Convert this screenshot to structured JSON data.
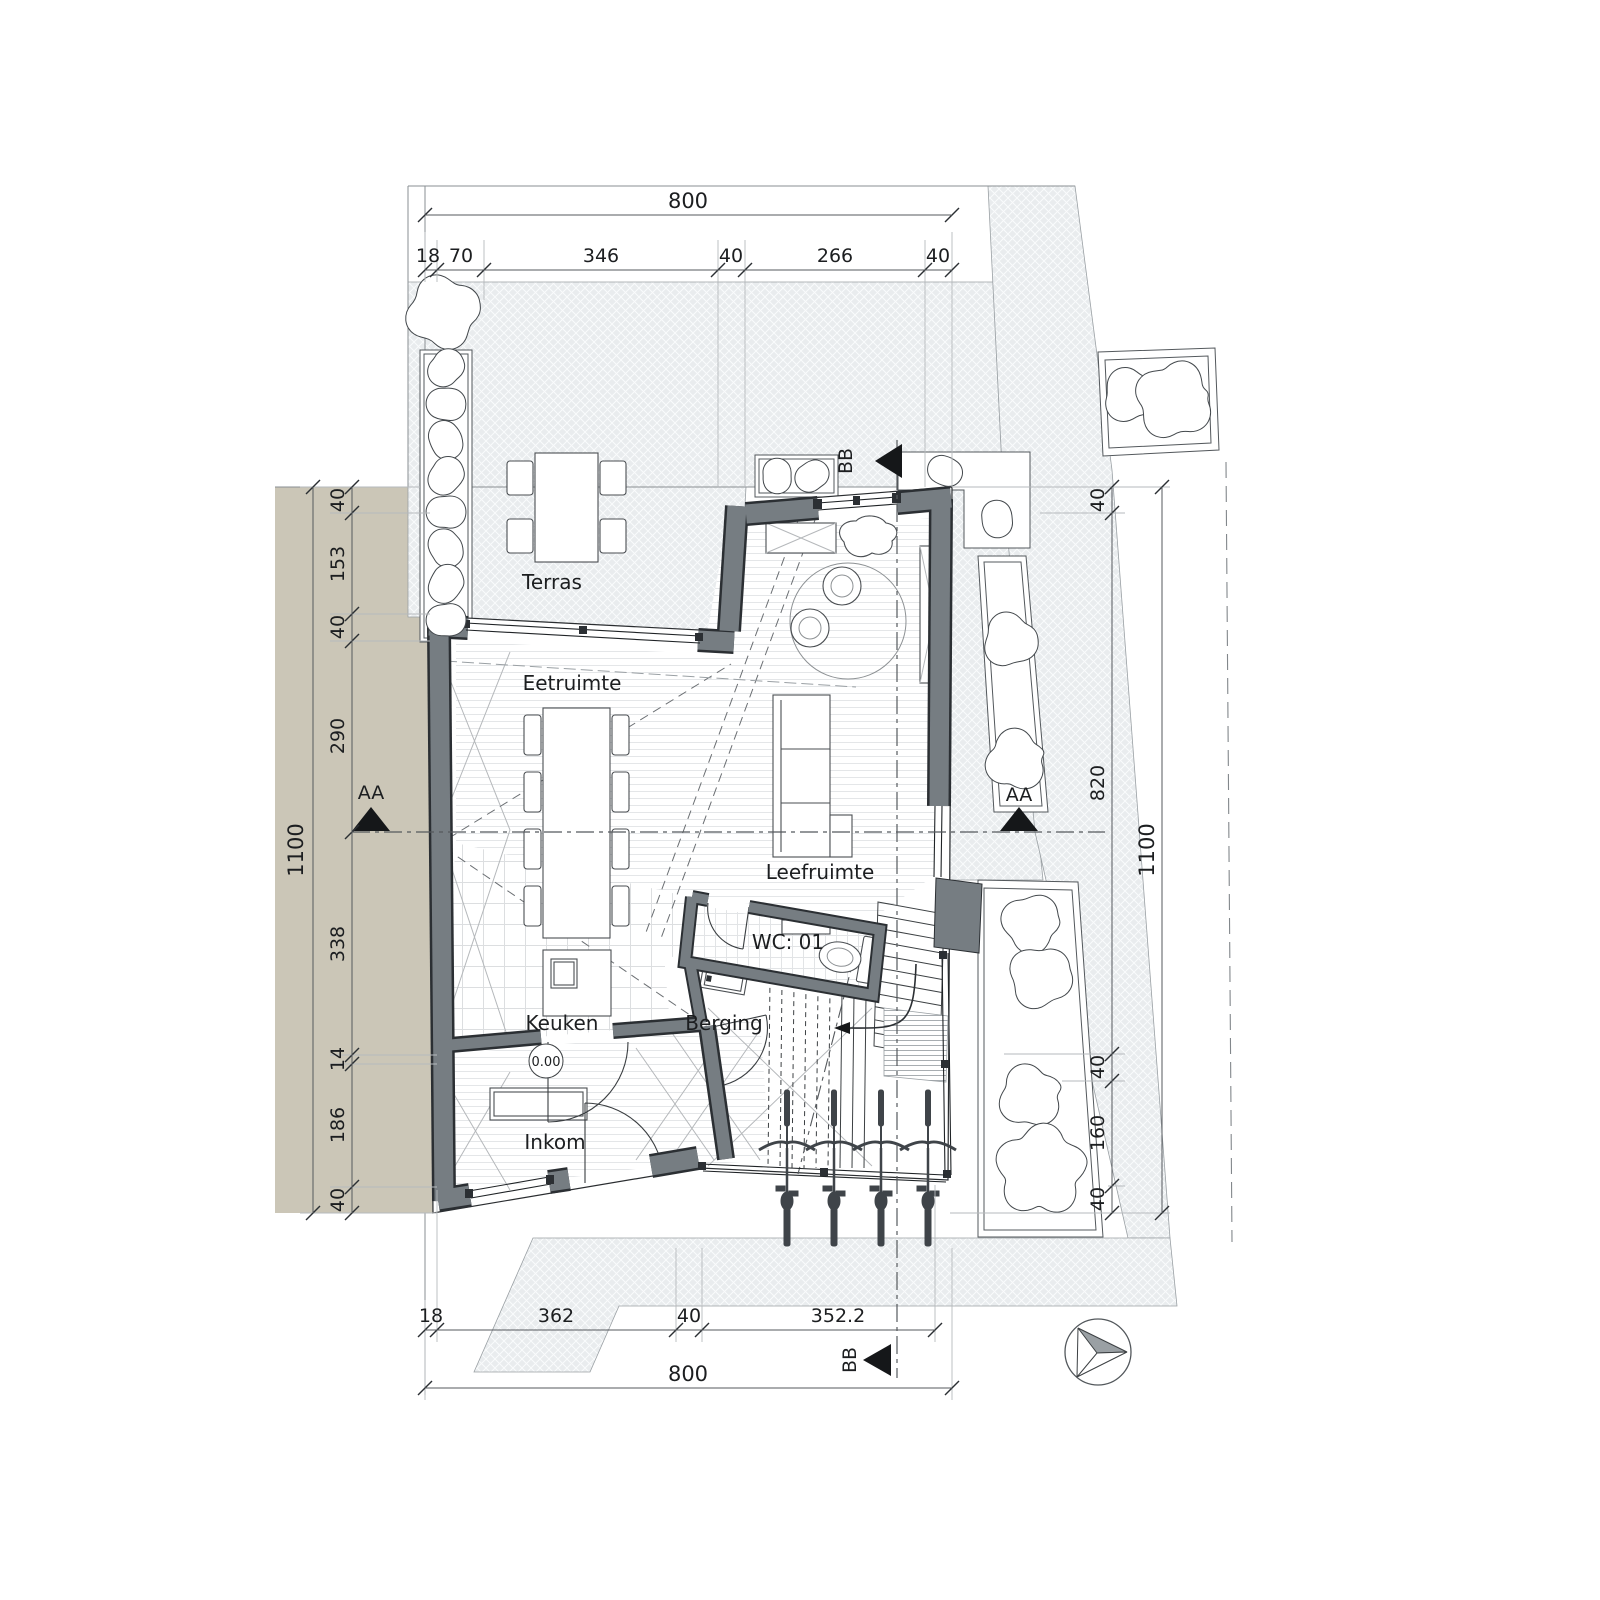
{
  "plan": {
    "rooms": {
      "terras": "Terras",
      "eetruimte": "Eetruimte",
      "leefruimte": "Leefruimte",
      "keuken": "Keuken",
      "berging": "Berging",
      "inkom": "Inkom",
      "wc": "WC: 01"
    },
    "level_marker": "0.00",
    "section_markers": {
      "aa": "AA",
      "bb": "BB"
    },
    "dimensions": {
      "top": {
        "overall": "800",
        "segments": [
          "18",
          "70",
          "346",
          "40",
          "266",
          "40"
        ]
      },
      "left": {
        "overall": "1100",
        "segments": [
          "40",
          "153",
          "40",
          "290",
          "338",
          "14",
          "186",
          "40"
        ]
      },
      "right": {
        "overall": "1100",
        "segments": [
          "40",
          "820",
          "40",
          "160",
          "40"
        ]
      },
      "bottom": {
        "overall": "800",
        "segments": [
          "18",
          "362",
          "40",
          "352.2"
        ]
      }
    },
    "colors": {
      "wall": "#767d82",
      "parcel": "#cbc6b7",
      "paving": "#e9ecee",
      "line": "#2a2d30"
    }
  }
}
